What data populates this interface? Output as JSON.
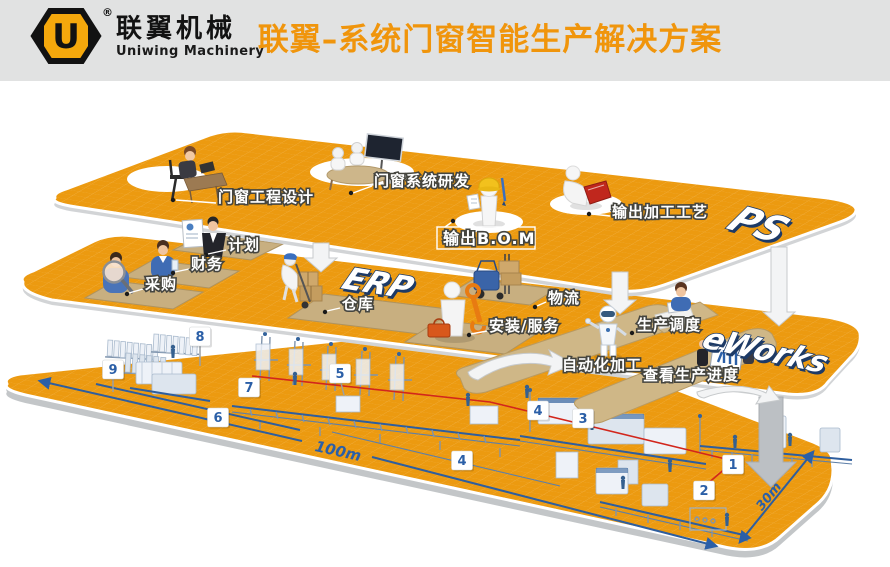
{
  "header": {
    "logo_letter": "U",
    "reg_mark": "®",
    "brand_cn": "联翼机械",
    "brand_en": "Uniwing Machinery",
    "title": "联翼–系统门窗智能生产解决方案"
  },
  "logos": {
    "top": "PS",
    "middle": "ERP",
    "front": "eWorks"
  },
  "stations": {
    "design": "门窗工程设计",
    "rd": "门窗系统研发",
    "bom": "输出B.O.M",
    "process": "输出加工工艺",
    "plan": "计划",
    "finance": "财务",
    "purchase": "采购",
    "warehouse": "仓库",
    "logistics": "物流",
    "install": "安装/服务",
    "auto": "自动化加工",
    "schedule": "生产调度",
    "progress": "查看生产进度"
  },
  "floor": {
    "badges": [
      "8",
      "9",
      "7",
      "5",
      "6",
      "4",
      "3",
      "4",
      "1",
      "2"
    ],
    "dim_length": "100m",
    "dim_width": "30m"
  }
}
